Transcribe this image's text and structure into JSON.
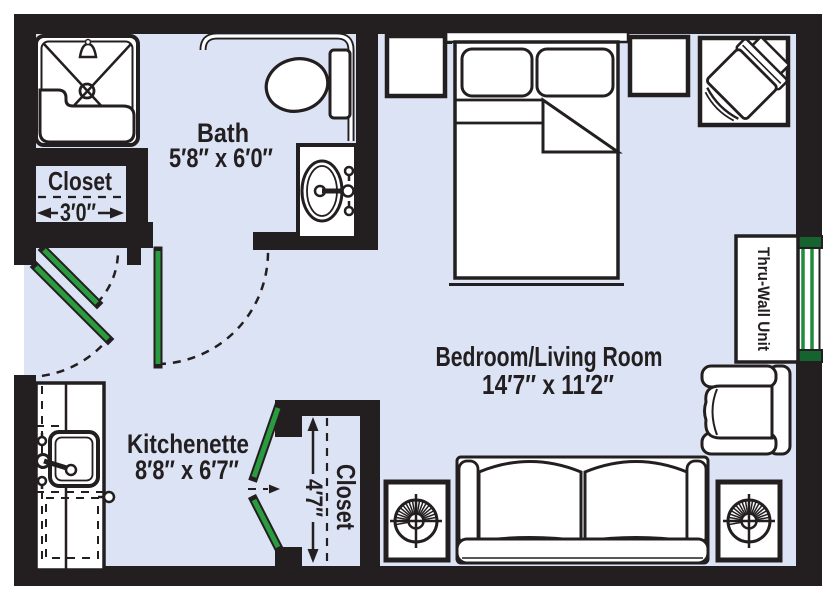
{
  "rooms": {
    "bath": {
      "name": "Bath",
      "dimensions": "5′8″ x 6′0″"
    },
    "bath_closet": {
      "name": "Closet",
      "width": "3′0″"
    },
    "bedroom_living": {
      "name": "Bedroom/Living Room",
      "dimensions": "14′7″ x 11′2″"
    },
    "kitchenette": {
      "name": "Kitchenette",
      "dimensions": "8′8″ x 6′7″"
    },
    "main_closet": {
      "name": "Closet",
      "depth": "4′7″"
    },
    "thru_wall_unit": {
      "label": "Thru-Wall Unit"
    }
  },
  "colors": {
    "floor": "#dce3f4",
    "wall": "#231f20",
    "door_green": "#2a9b3f",
    "window_green": "#1f8c3d",
    "window_cap": "#15632f",
    "fixture": "#ffffff"
  }
}
